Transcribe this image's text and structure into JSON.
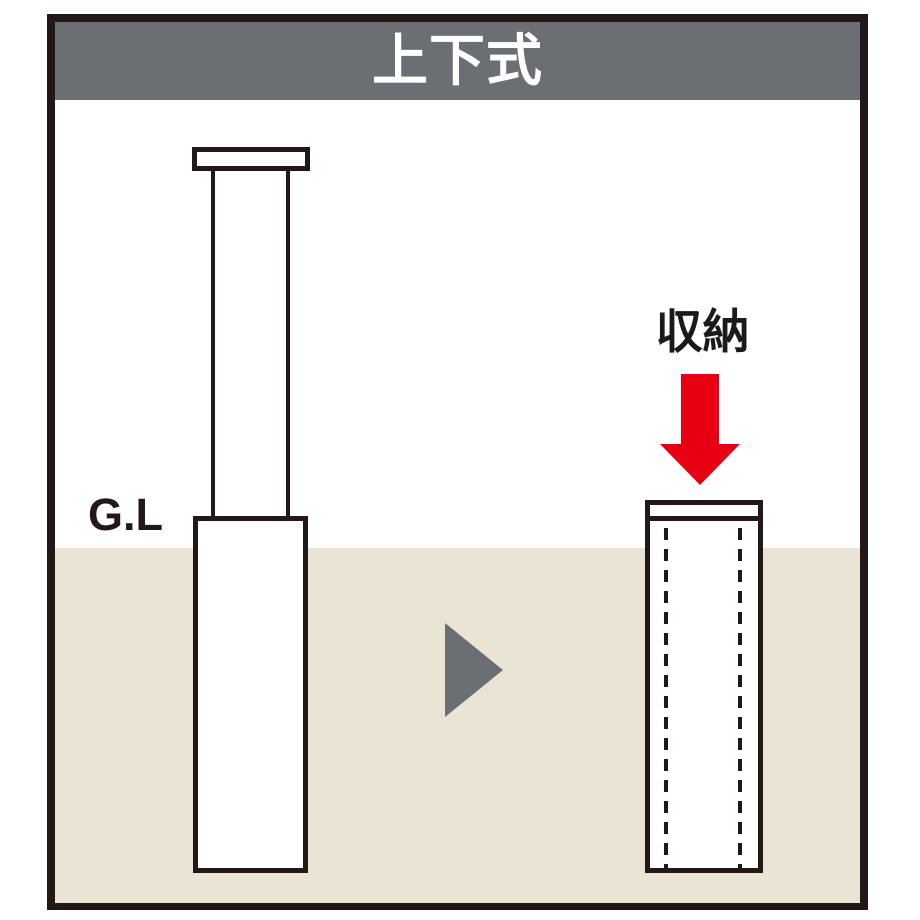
{
  "header": {
    "title": "上下式"
  },
  "diagram": {
    "ground_level_label": "G.L",
    "storage_label": "収納",
    "icons": {
      "transition_arrow": "right-pointing-triangle",
      "storage_arrow": "red-down-arrow"
    }
  },
  "colors": {
    "frame_border": "#231815",
    "header_bg": "#6a6f73",
    "header_text": "#ffffff",
    "ground_fill": "#e9e4d3",
    "bollard_fill": "#ffffff",
    "line_black": "#231815",
    "arrow_red": "#e60012",
    "triangle_gray": "#6a6f73"
  }
}
